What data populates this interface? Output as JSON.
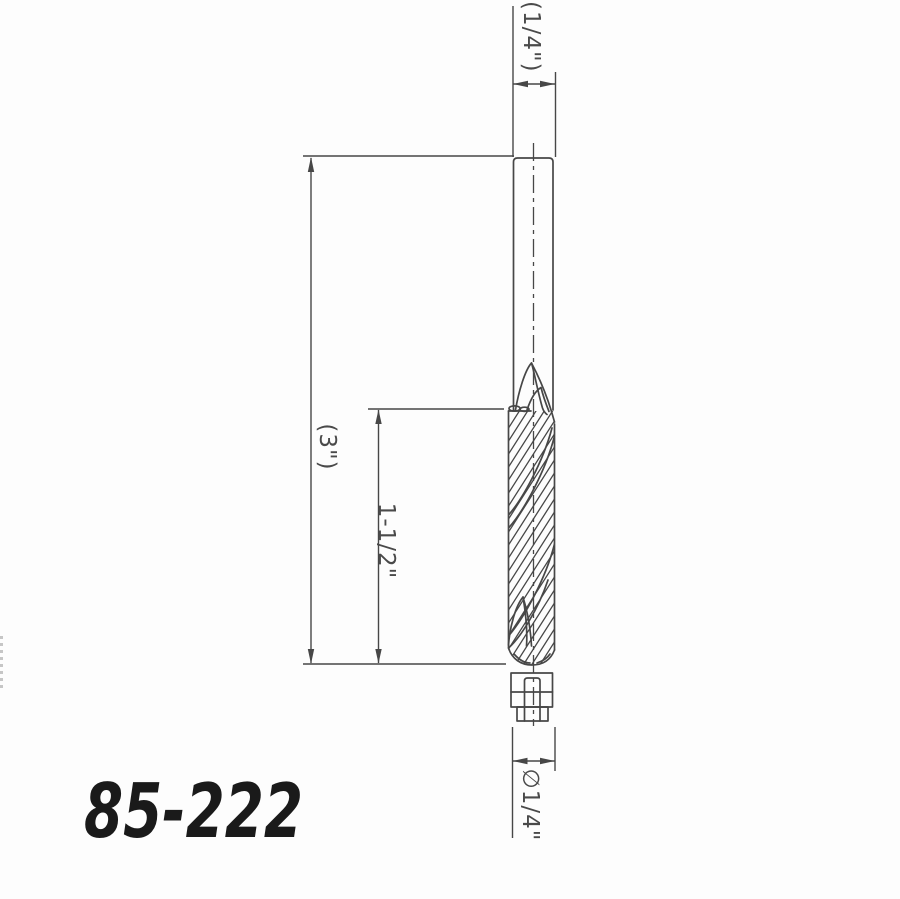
{
  "drawing": {
    "part_number": "85-222",
    "labels": {
      "shank_diameter": "(1/4\")",
      "overall_length": "(3\")",
      "flute_length": "1-1/2\"",
      "tip_diameter": "∅1/4\""
    },
    "colors": {
      "background": "#fdfdfd",
      "line": "#474747",
      "dimension_text": "#4a4a4a",
      "part_number_text": "#1a1a1a"
    }
  }
}
